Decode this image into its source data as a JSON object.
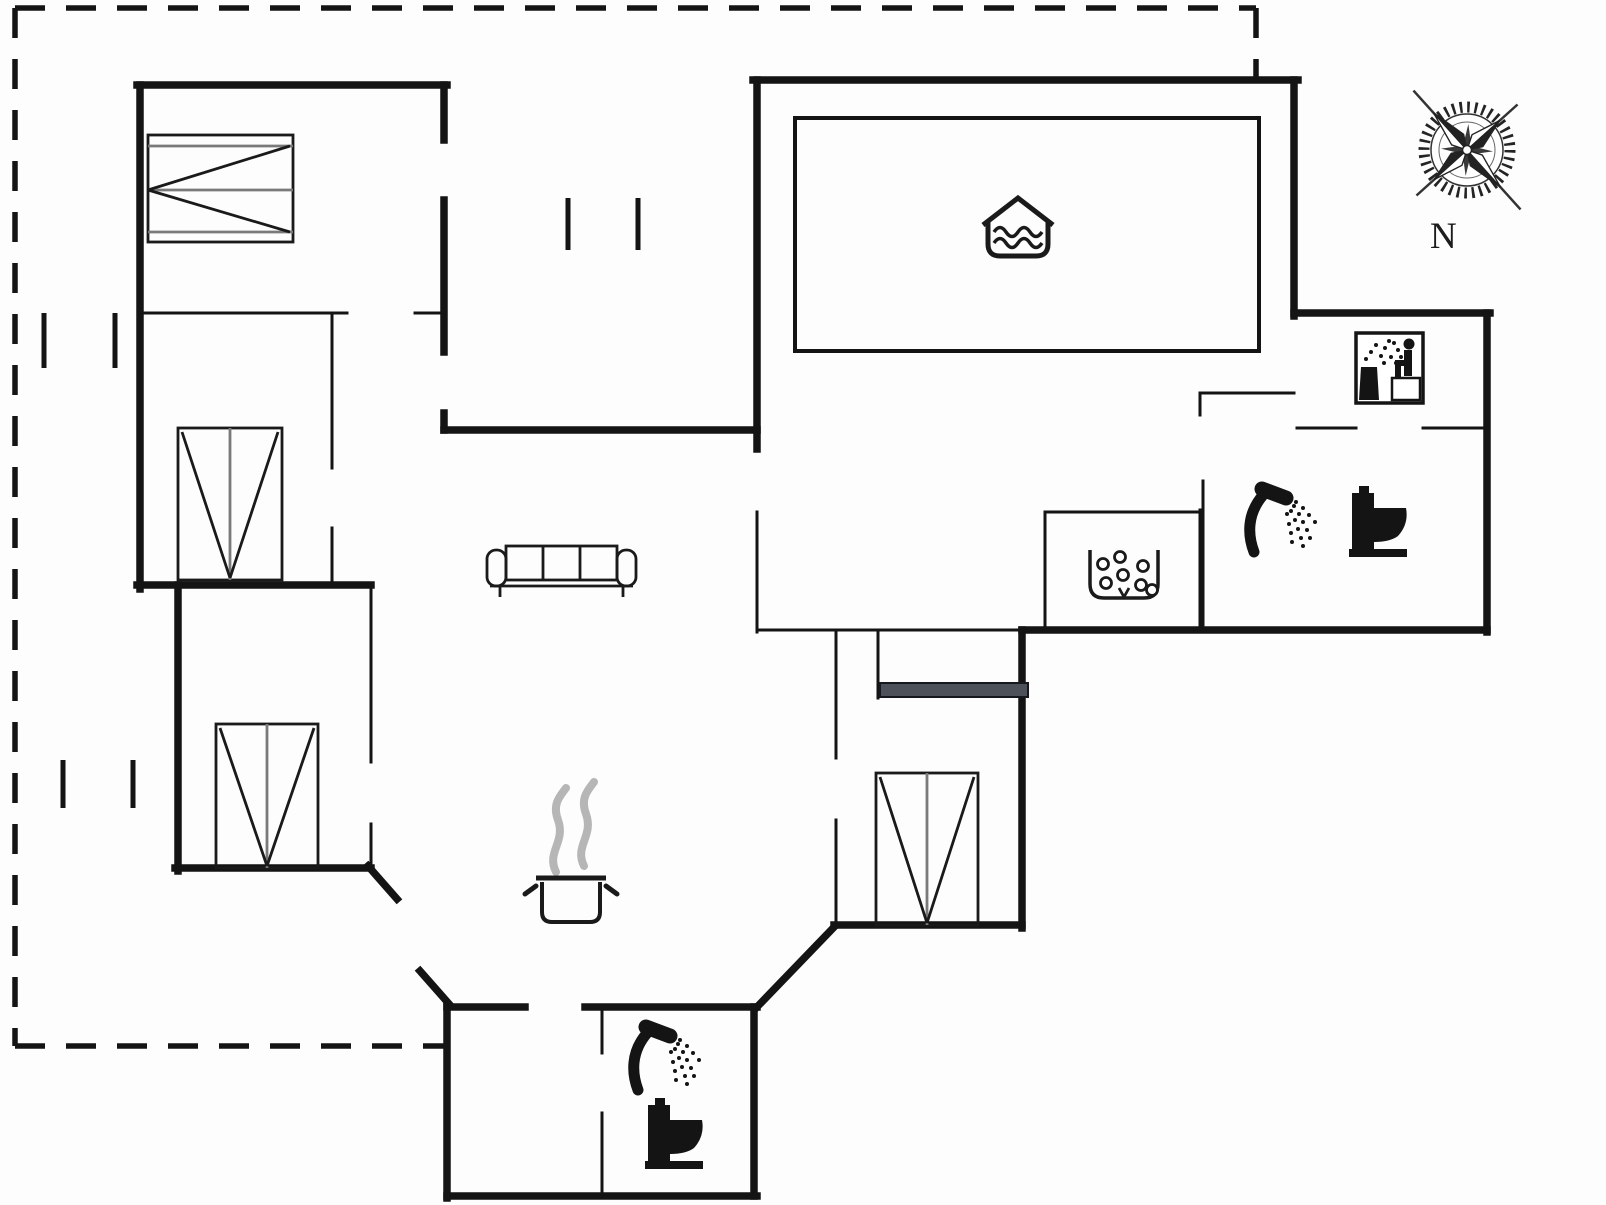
{
  "diagram": {
    "type": "vacation-house-floor-plan",
    "compass": {
      "label": "N"
    },
    "icons": {
      "compass_rose": "compass-rose-icon",
      "indoor_pool_basin": "pool-water-icon",
      "sauna": "sauna-icon",
      "whirlpool": "whirlpool-bubbles-icon",
      "wood_stove": "stove-pot-steam-icon",
      "sofa": "sofa-icon",
      "double_bed": "bed-icon",
      "shower": "shower-icon",
      "toilet": "toilet-icon",
      "sliding_door": "sliding-door-bar",
      "terrace_outline": "dashed-terrace-outline",
      "window_marks": "window-tick-icon"
    },
    "inventory": {
      "beds": 4,
      "sofas": 1,
      "showers": 2,
      "toilets": 2,
      "saunas": 1,
      "whirlpools": 1,
      "pool_basins": 1,
      "wood_stoves": 1
    },
    "palette": {
      "wall": "#141414",
      "background": "#fdfdfd",
      "steam_gray": "#b6b6b6",
      "mattress_gray": "#7a7a7a",
      "sliding_door_gray": "#4d525a"
    }
  }
}
